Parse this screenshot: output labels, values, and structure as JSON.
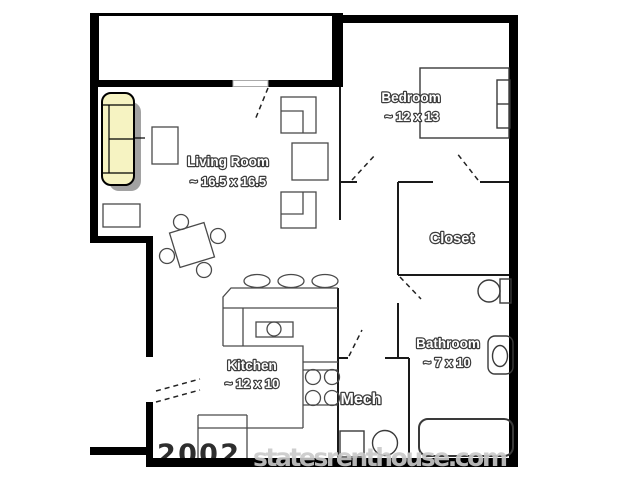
{
  "rooms": {
    "living": {
      "name": "Living Room",
      "dims": "~ 16.5 x 16.5"
    },
    "bedroom": {
      "name": "Bedroom",
      "dims": "~ 12 x 13"
    },
    "closet": {
      "name": "Closet"
    },
    "kitchen": {
      "name": "Kitchen",
      "dims": "~ 12 x 10"
    },
    "bathroom": {
      "name": "Bathroom",
      "dims": "~ 7 x 10"
    },
    "mech": {
      "name": "Mech"
    }
  },
  "watermark": {
    "prefix": "2002",
    "site": "statesrenthouse.com"
  },
  "colors": {
    "wall": "#000000",
    "furniture_line": "#4a4a4a",
    "sofa_fill": "#F6F3C2",
    "sofa_shadow": "#A2A2A2",
    "label_fill": "#ffffff",
    "label_outline": "#3c3c3c",
    "watermark_gray": "#c9c9c9",
    "watermark_prefix_dark": "#2e2e2e"
  }
}
